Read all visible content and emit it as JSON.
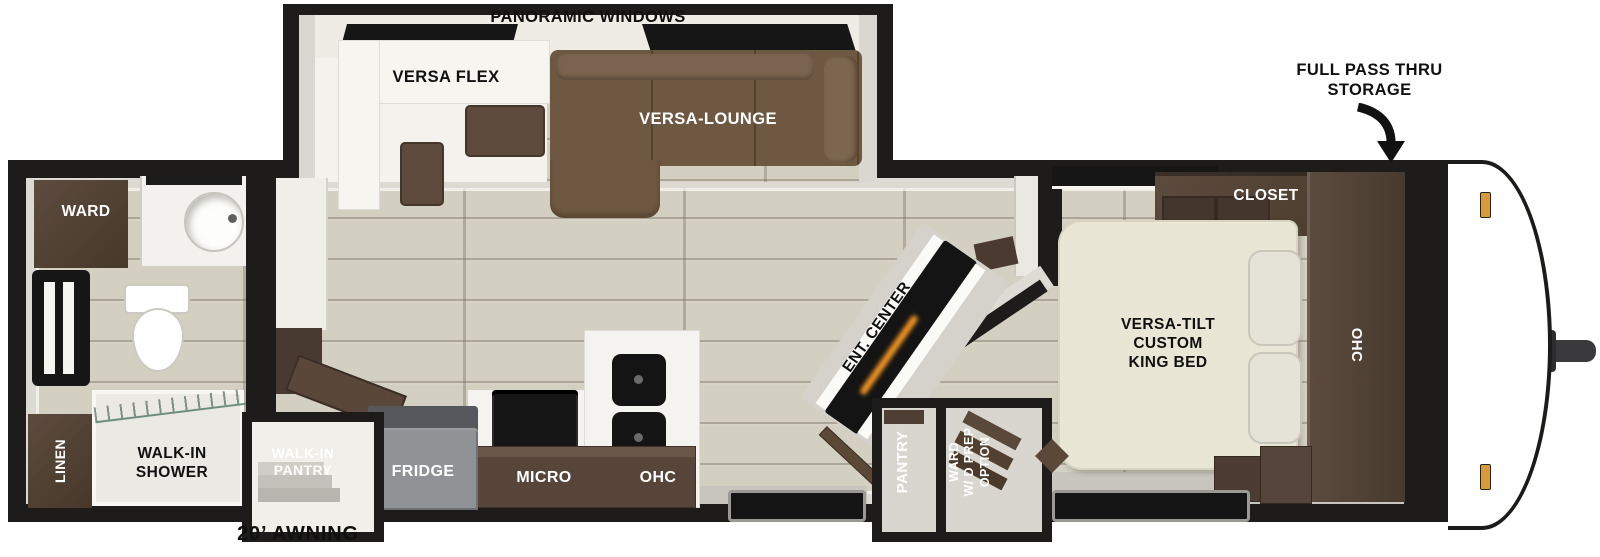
{
  "colors": {
    "wall_black": "#1d1c1a",
    "floor_wood": "#d3cfc1",
    "cabinet_brown": "#4e3e33",
    "sofa_brown": "#6e5841",
    "bed_cream": "#eae6d5",
    "counter_white": "#f4f3ef",
    "appliance_black": "#161616",
    "fridge_gray": "#8f9295",
    "shower_glass_teal": "#bcd8cb",
    "fireplace_glow_orange": "#ef9322",
    "marker_amber": "#d89b3c"
  },
  "floorplan": {
    "slide_out": {
      "panoramic_windows": "PANORAMIC WINDOWS",
      "versa_flex": "VERSA FLEX",
      "versa_lounge": "VERSA-LOUNGE"
    },
    "front": {
      "full_pass_thru_storage": "FULL PASS THRU\nSTORAGE"
    },
    "bedroom": {
      "closet": "CLOSET",
      "overhead_cabinet": "OHC",
      "bed": "VERSA-TILT\nCUSTOM\nKING BED"
    },
    "living": {
      "ent_center": "ENT. CENTER",
      "pantry": "PANTRY",
      "ward_wd_prep": "WARD\nW/ D PREP\nOPTION"
    },
    "kitchen": {
      "walk_in_pantry": "WALK-IN\nPANTRY",
      "fridge": "FRIDGE",
      "micro": "MICRO",
      "overhead_cabinet": "OHC"
    },
    "bathroom": {
      "ward": "WARD",
      "linen": "LINEN",
      "walk_in_shower": "WALK-IN\nSHOWER"
    },
    "exterior": {
      "awning": "20’ AWNING"
    }
  }
}
